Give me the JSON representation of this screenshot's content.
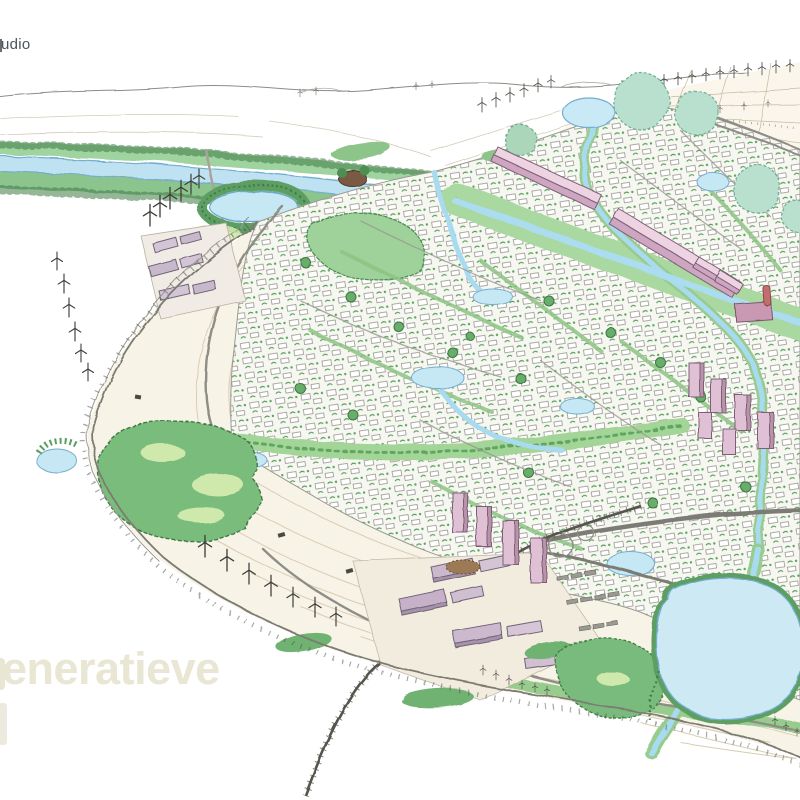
{
  "page": {
    "background_color": "#ffffff"
  },
  "branding": {
    "studio_label": "udio"
  },
  "title": {
    "text": "eneratieve",
    "color": "#e9e6d4"
  },
  "illustration_alt": "Hand-drawn aerial illustration of a circular garden city surrounded by farmland, wind turbines, canals, ponds and green belts",
  "palette": {
    "pencil_ink": "#4a4a44",
    "field_cream": "#f6efe0",
    "tree_green_dark": "#3f7a44",
    "tree_green": "#6ab06c",
    "meadow_green": "#b7e0a8",
    "canopy_teal": "#b9dfcf",
    "water_blue": "#c6e8f5",
    "canal_blue": "#a8daf0",
    "building_pink": "#e3c3d6",
    "warehouse_mauve": "#cbb7cb",
    "road_gray": "#8e8e85",
    "rail_dark": "#55554e",
    "title_beige": "#e9e6d4",
    "logo_gray": "#4b545b"
  }
}
